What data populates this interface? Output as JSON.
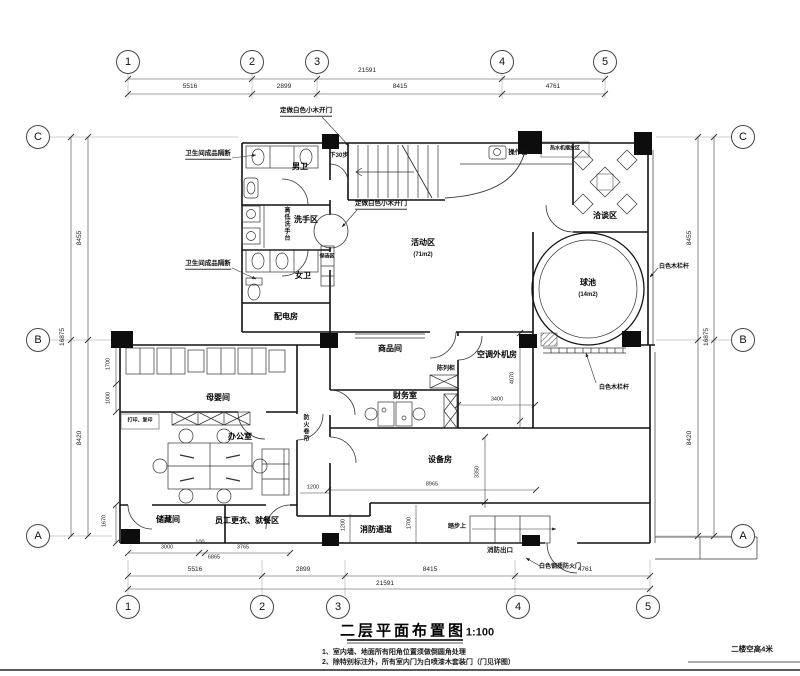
{
  "drawing": {
    "title": "二层平面布置图",
    "scale": "1:100",
    "floor_note": "二楼空高4米",
    "note1": "1、室内墙、地面所有阳角位置须做倒圆角处理",
    "note2": "2、除特别标注外，所有室内门为白喷漆木套装门（门见详图）"
  },
  "grid": {
    "cols": [
      "1",
      "2",
      "3",
      "4",
      "5"
    ],
    "rows": [
      "C",
      "B",
      "A"
    ]
  },
  "dims": {
    "top_overall": "21591",
    "top1": "5516",
    "top2": "2899",
    "top3": "8415",
    "top4": "4761",
    "bottom_overall": "21591",
    "bi1": "3000",
    "bi2": "100",
    "bi3": "6865",
    "bi4": "3765",
    "side_overall": "16875",
    "left1": "8455",
    "left2": "8420",
    "li1": "1700",
    "li2": "1000",
    "li3": "1670",
    "d4070": "4070",
    "d3400": "3400",
    "d8965": "8965",
    "d3350": "3350",
    "d1200v": "1200",
    "d1700v": "1700",
    "d1200h": "1200"
  },
  "rooms": {
    "mens_wc": "男卫",
    "wash_area": "洗手区",
    "womens_wc": "女卫",
    "power_room": "配电房",
    "activity": "活动区",
    "activity_size": "(71m2)",
    "meeting": "洽谈区",
    "ball_pool": "球池",
    "ball_pool_size": "(14m2)",
    "goods": "商品间",
    "ac_room": "空调外机房",
    "display_cabinet": "陈列柜",
    "finance": "财务室",
    "nursing": "母婴间",
    "office": "办公室",
    "storage": "储藏间",
    "staff": "员工更衣、就餐区",
    "equipment": "设备房",
    "fire_corridor": "消防通道"
  },
  "annotations": {
    "partition": "卫生间成品隔断",
    "sink_counter": "高低洗手台",
    "cleaning": "保洁区",
    "stairs_down": "下30步",
    "custom_door": "定做白色小木开门",
    "counter": "操作台",
    "water_heater": "热水机摆放区",
    "white_rail": "白色木栏杆",
    "print_copy": "打印、复印",
    "fire_shutter": "防火卷帘",
    "step_up": "踏步上",
    "fire_exit": "消防出口",
    "fire_door": "白色钢质防火门"
  }
}
